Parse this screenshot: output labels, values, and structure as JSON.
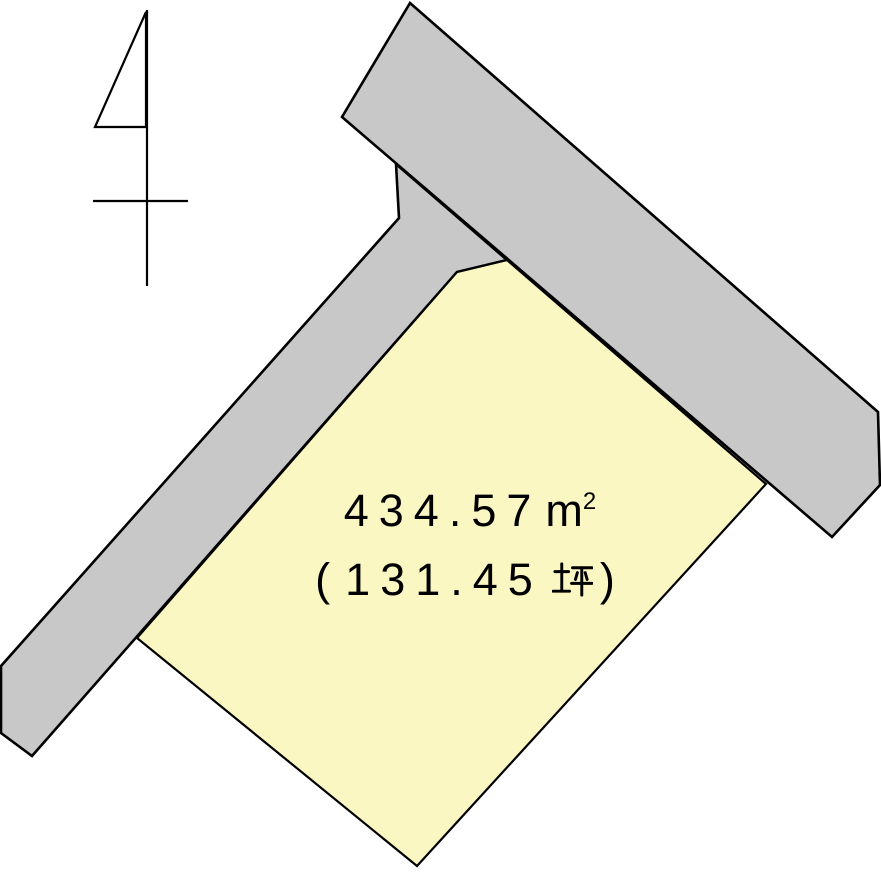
{
  "page": {
    "kind": "land-plot-survey-diagram",
    "background": "#FFFFFF"
  },
  "colors": {
    "road_fill": "#C8C8C8",
    "road_stroke": "#000000",
    "plot_fill": "#FAF7C3",
    "plot_stroke": "#000000",
    "arrow_stroke": "#000000",
    "text": "#000000"
  },
  "icons": {
    "north_arrow": "survey-north-arrow"
  },
  "plot": {
    "area_label": "４３４.５７㎡",
    "tsubo_label": "（１３１.４５坪）",
    "area_value": "434.57",
    "area_unit_base": "m",
    "area_unit_exponent": "2",
    "tsubo_open_paren": "(",
    "tsubo_value": "131.45",
    "tsubo_unit": "坪",
    "tsubo_close_paren": ")"
  }
}
